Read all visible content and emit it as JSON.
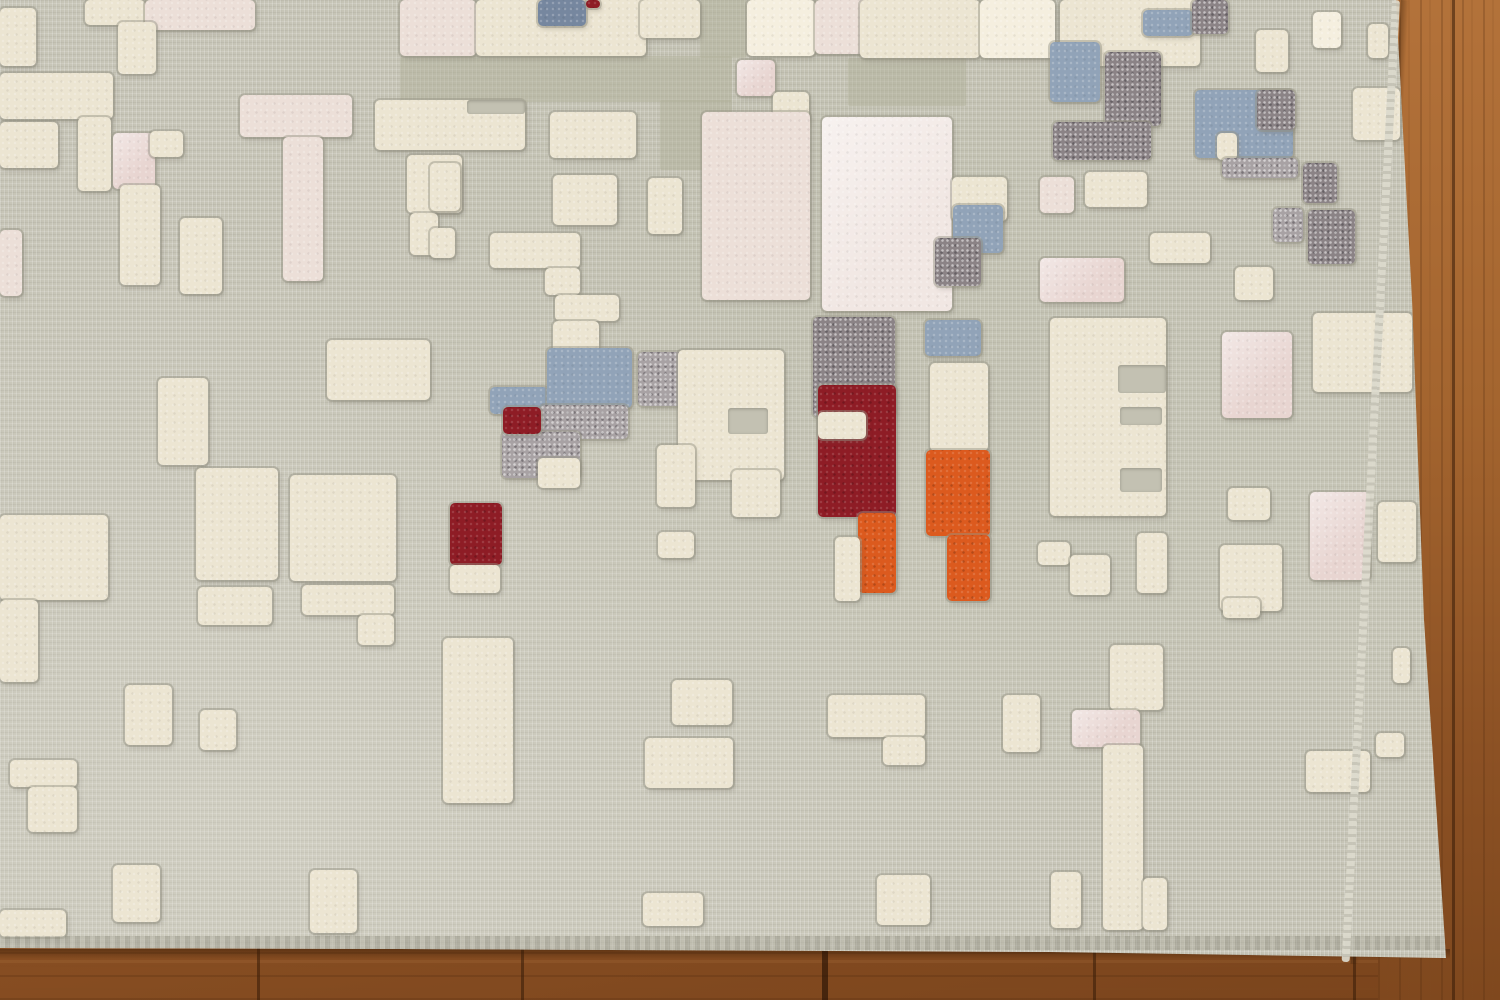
{
  "scene": {
    "subject": "abstract modern area rug on hardwood floor",
    "rug_style": "gray woven base with raised high-pile rectangular blocks",
    "floor_visible_edges": [
      "right",
      "bottom"
    ]
  },
  "palette": {
    "rug_base": "#c6c4b6",
    "iv": "#ece5d2",
    "iv2": "#f5efdf",
    "pk": "#ecdfd8",
    "pkw": "#f1e7e3",
    "pk2": "#e8d5d1",
    "bg": "#91a3b8",
    "bgd": "#76879f",
    "dg": "#8b8386",
    "dg2": "#a8a2a4",
    "rd": "#8e1c25",
    "or": "#dc5a1e",
    "cut": "#c3c1b2",
    "shade": "rgba(173,173,151,0.42)",
    "wood_light": "#ad6d35",
    "wood_dark": "#7a441c",
    "seam": "rgba(55,28,8,0.55)"
  },
  "floor": {
    "bottom_seams": [
      257,
      521,
      1093,
      1353
    ],
    "bottom_seams_wide": [
      822
    ],
    "right_seams": [
      1452
    ]
  },
  "rug": {
    "blocks": [
      [
        400,
        56,
        332,
        46,
        "shade"
      ],
      [
        700,
        0,
        46,
        58,
        "shade"
      ],
      [
        660,
        100,
        72,
        70,
        "shade"
      ],
      [
        882,
        240,
        46,
        72,
        "shade"
      ],
      [
        848,
        58,
        118,
        48,
        "shade"
      ],
      [
        0,
        8,
        36,
        58,
        "iv"
      ],
      [
        85,
        0,
        60,
        25,
        "iv"
      ],
      [
        145,
        0,
        110,
        30,
        "pk"
      ],
      [
        118,
        22,
        38,
        52,
        "iv"
      ],
      [
        0,
        73,
        113,
        46,
        "iv"
      ],
      [
        0,
        122,
        58,
        46,
        "iv"
      ],
      [
        78,
        117,
        33,
        74,
        "iv"
      ],
      [
        113,
        133,
        42,
        56,
        "pk2"
      ],
      [
        150,
        131,
        33,
        26,
        "iv"
      ],
      [
        120,
        185,
        40,
        100,
        "iv"
      ],
      [
        180,
        218,
        42,
        76,
        "iv"
      ],
      [
        240,
        95,
        112,
        42,
        "pk"
      ],
      [
        283,
        137,
        40,
        144,
        "pk"
      ],
      [
        0,
        230,
        22,
        66,
        "pk"
      ],
      [
        375,
        100,
        150,
        50,
        "iv"
      ],
      [
        407,
        155,
        55,
        58,
        "iv"
      ],
      [
        410,
        213,
        28,
        42,
        "iv"
      ],
      [
        158,
        378,
        50,
        87,
        "iv"
      ],
      [
        327,
        340,
        103,
        60,
        "iv"
      ],
      [
        196,
        468,
        82,
        112,
        "iv"
      ],
      [
        290,
        475,
        106,
        106,
        "iv"
      ],
      [
        0,
        515,
        108,
        85,
        "iv"
      ],
      [
        0,
        600,
        38,
        82,
        "iv"
      ],
      [
        198,
        587,
        74,
        38,
        "iv"
      ],
      [
        302,
        585,
        92,
        30,
        "iv"
      ],
      [
        358,
        615,
        36,
        30,
        "iv"
      ],
      [
        125,
        685,
        47,
        60,
        "iv"
      ],
      [
        200,
        710,
        36,
        40,
        "iv"
      ],
      [
        443,
        638,
        70,
        165,
        "iv"
      ],
      [
        10,
        760,
        67,
        27,
        "iv"
      ],
      [
        28,
        787,
        49,
        45,
        "iv"
      ],
      [
        113,
        865,
        47,
        57,
        "iv"
      ],
      [
        310,
        870,
        47,
        63,
        "iv"
      ],
      [
        0,
        910,
        66,
        27,
        "iv"
      ],
      [
        400,
        0,
        76,
        56,
        "pk"
      ],
      [
        476,
        0,
        170,
        56,
        "iv"
      ],
      [
        538,
        0,
        48,
        26,
        "bgd"
      ],
      [
        586,
        0,
        14,
        8,
        "rd"
      ],
      [
        640,
        0,
        60,
        38,
        "iv"
      ],
      [
        747,
        0,
        68,
        56,
        "iv2"
      ],
      [
        815,
        0,
        55,
        54,
        "pk"
      ],
      [
        860,
        0,
        120,
        58,
        "iv"
      ],
      [
        980,
        0,
        75,
        58,
        "iv2"
      ],
      [
        737,
        60,
        38,
        36,
        "pk2"
      ],
      [
        773,
        92,
        36,
        30,
        "iv"
      ],
      [
        550,
        112,
        86,
        46,
        "iv"
      ],
      [
        430,
        163,
        30,
        48,
        "iv"
      ],
      [
        553,
        175,
        64,
        50,
        "iv"
      ],
      [
        648,
        178,
        34,
        56,
        "iv"
      ],
      [
        430,
        228,
        25,
        30,
        "iv"
      ],
      [
        490,
        233,
        90,
        35,
        "iv"
      ],
      [
        545,
        268,
        35,
        27,
        "iv"
      ],
      [
        555,
        295,
        64,
        26,
        "iv"
      ],
      [
        553,
        321,
        46,
        38,
        "iv"
      ],
      [
        702,
        112,
        108,
        188,
        "pk"
      ],
      [
        822,
        117,
        130,
        194,
        "pkw"
      ],
      [
        952,
        177,
        55,
        44,
        "iv"
      ],
      [
        953,
        205,
        50,
        48,
        "bg"
      ],
      [
        935,
        238,
        46,
        48,
        "dg"
      ],
      [
        813,
        317,
        82,
        100,
        "dg"
      ],
      [
        925,
        320,
        56,
        36,
        "bg"
      ],
      [
        818,
        385,
        78,
        132,
        "rd"
      ],
      [
        818,
        412,
        48,
        27,
        "iv"
      ],
      [
        858,
        513,
        38,
        80,
        "or"
      ],
      [
        835,
        537,
        25,
        64,
        "iv"
      ],
      [
        930,
        363,
        58,
        88,
        "iv"
      ],
      [
        926,
        450,
        64,
        86,
        "or"
      ],
      [
        947,
        535,
        43,
        66,
        "or"
      ],
      [
        490,
        387,
        58,
        27,
        "bg"
      ],
      [
        547,
        348,
        85,
        60,
        "bg"
      ],
      [
        540,
        405,
        88,
        34,
        "dg2"
      ],
      [
        502,
        432,
        78,
        46,
        "dg2"
      ],
      [
        503,
        407,
        38,
        27,
        "rd"
      ],
      [
        538,
        458,
        42,
        30,
        "iv"
      ],
      [
        638,
        352,
        90,
        54,
        "dg2"
      ],
      [
        678,
        350,
        106,
        130,
        "iv"
      ],
      [
        657,
        445,
        38,
        62,
        "iv"
      ],
      [
        732,
        470,
        48,
        47,
        "iv"
      ],
      [
        658,
        532,
        36,
        26,
        "iv"
      ],
      [
        450,
        503,
        52,
        62,
        "rd"
      ],
      [
        450,
        565,
        50,
        28,
        "iv"
      ],
      [
        1050,
        318,
        116,
        198,
        "iv"
      ],
      [
        1222,
        332,
        70,
        86,
        "pk2"
      ],
      [
        1313,
        313,
        99,
        79,
        "iv"
      ],
      [
        1228,
        488,
        42,
        32,
        "iv"
      ],
      [
        1310,
        492,
        60,
        88,
        "pk2"
      ],
      [
        1378,
        502,
        38,
        60,
        "iv"
      ],
      [
        1220,
        545,
        62,
        66,
        "iv"
      ],
      [
        1038,
        542,
        32,
        23,
        "iv"
      ],
      [
        1070,
        555,
        40,
        40,
        "iv"
      ],
      [
        1137,
        533,
        30,
        60,
        "iv"
      ],
      [
        1060,
        0,
        140,
        66,
        "iv"
      ],
      [
        1050,
        42,
        50,
        60,
        "bg"
      ],
      [
        1105,
        52,
        56,
        74,
        "dg"
      ],
      [
        1053,
        122,
        98,
        38,
        "dg"
      ],
      [
        1143,
        10,
        50,
        26,
        "bg"
      ],
      [
        1192,
        0,
        36,
        34,
        "dg"
      ],
      [
        1256,
        30,
        32,
        42,
        "iv"
      ],
      [
        1313,
        12,
        28,
        36,
        "iv2"
      ],
      [
        1368,
        24,
        20,
        34,
        "iv"
      ],
      [
        1195,
        90,
        98,
        68,
        "bg"
      ],
      [
        1257,
        90,
        38,
        40,
        "dg"
      ],
      [
        1217,
        133,
        20,
        27,
        "iv"
      ],
      [
        1222,
        158,
        76,
        20,
        "dg2"
      ],
      [
        1303,
        163,
        34,
        40,
        "dg"
      ],
      [
        1273,
        208,
        30,
        34,
        "dg2"
      ],
      [
        1308,
        210,
        47,
        54,
        "dg"
      ],
      [
        1040,
        177,
        34,
        36,
        "pk"
      ],
      [
        1085,
        172,
        62,
        35,
        "iv"
      ],
      [
        1353,
        88,
        47,
        52,
        "iv"
      ],
      [
        1040,
        258,
        84,
        44,
        "pk2"
      ],
      [
        1150,
        233,
        60,
        30,
        "iv"
      ],
      [
        1235,
        267,
        38,
        33,
        "iv"
      ],
      [
        672,
        680,
        60,
        45,
        "iv"
      ],
      [
        645,
        738,
        88,
        50,
        "iv"
      ],
      [
        828,
        695,
        97,
        42,
        "iv"
      ],
      [
        883,
        737,
        42,
        28,
        "iv"
      ],
      [
        643,
        893,
        60,
        33,
        "iv"
      ],
      [
        877,
        875,
        53,
        50,
        "iv"
      ],
      [
        1003,
        695,
        37,
        57,
        "iv"
      ],
      [
        1110,
        645,
        53,
        65,
        "iv"
      ],
      [
        1072,
        710,
        68,
        37,
        "pk2"
      ],
      [
        1103,
        745,
        40,
        185,
        "iv"
      ],
      [
        1143,
        878,
        24,
        52,
        "iv"
      ],
      [
        1051,
        872,
        30,
        56,
        "iv"
      ],
      [
        1223,
        598,
        37,
        20,
        "iv"
      ],
      [
        1306,
        751,
        64,
        41,
        "iv"
      ],
      [
        1376,
        733,
        28,
        24,
        "iv"
      ],
      [
        1393,
        648,
        17,
        35,
        "iv"
      ],
      [
        1118,
        365,
        48,
        28,
        "cut"
      ],
      [
        1120,
        407,
        42,
        18,
        "cut"
      ],
      [
        1120,
        468,
        42,
        24,
        "cut"
      ],
      [
        728,
        408,
        40,
        26,
        "cut"
      ],
      [
        467,
        100,
        58,
        14,
        "cut"
      ]
    ]
  }
}
